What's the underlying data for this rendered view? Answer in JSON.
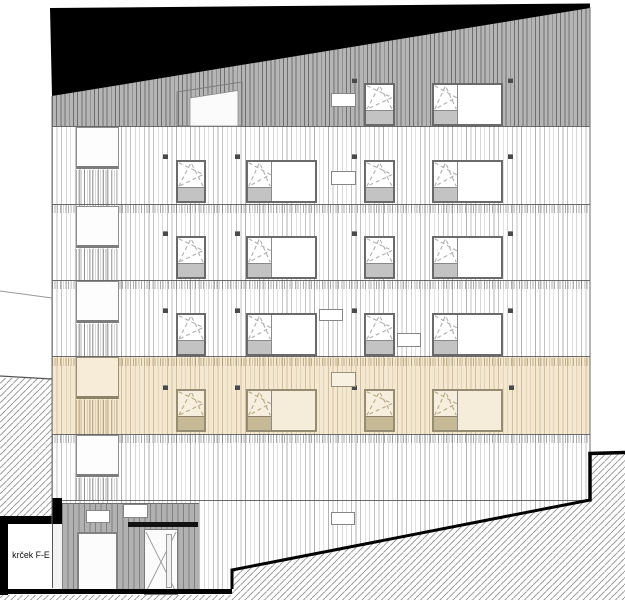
{
  "drawing": {
    "kind": "building facade elevation",
    "annotation": {
      "label": "krček F-E"
    }
  },
  "colors": {
    "roof_black": "#000000",
    "attic_band_gray": "#b5b5b5",
    "facade_white": "#ffffff",
    "highlight_beige": "#f4e8d1",
    "entrance_gray": "#b1b1b1",
    "window_frame_gray": "#6a6a6a",
    "spandrel_gray": "#c3c3c3",
    "beige_spandrel": "#c6b995",
    "terrain_hatch_gray": "#8f8f8f",
    "outline_black": "#000000"
  },
  "facade": {
    "cladding": "vertical slat stripes",
    "rows": [
      {
        "id": "attic",
        "band": "gray",
        "windows": [
          "stair-glazing",
          "tilt-turn",
          "tilt-turn-with-fixed"
        ],
        "vents": 2,
        "signs": 1
      },
      {
        "id": "floor-4",
        "band": "white",
        "windows": [
          "square",
          "tilt-turn",
          "tilt-turn-with-fixed",
          "tilt-turn",
          "tilt-turn-with-fixed"
        ],
        "vents": 4,
        "signs": 1
      },
      {
        "id": "floor-3",
        "band": "white",
        "windows": [
          "square",
          "tilt-turn",
          "tilt-turn-with-fixed",
          "tilt-turn",
          "tilt-turn-with-fixed"
        ],
        "vents": 4,
        "signs": 0
      },
      {
        "id": "floor-2",
        "band": "white",
        "windows": [
          "square",
          "tilt-turn",
          "tilt-turn-with-fixed",
          "tilt-turn",
          "tilt-turn-with-fixed"
        ],
        "vents": 4,
        "signs": 2
      },
      {
        "id": "floor-1",
        "band": "beige-highlight",
        "windows": [
          "square",
          "tilt-turn",
          "tilt-turn-with-fixed",
          "tilt-turn",
          "tilt-turn-with-fixed"
        ],
        "vents": 4,
        "signs": 1
      },
      {
        "id": "ground",
        "band": "white",
        "windows": [
          "square"
        ],
        "vents": 0,
        "signs": 1
      }
    ],
    "entrance": {
      "shop_window": true,
      "canopy": true,
      "glazed_door": true,
      "signs": 2
    },
    "terrain": {
      "left_hatch_section": true,
      "right_slope_hatch": true
    }
  }
}
